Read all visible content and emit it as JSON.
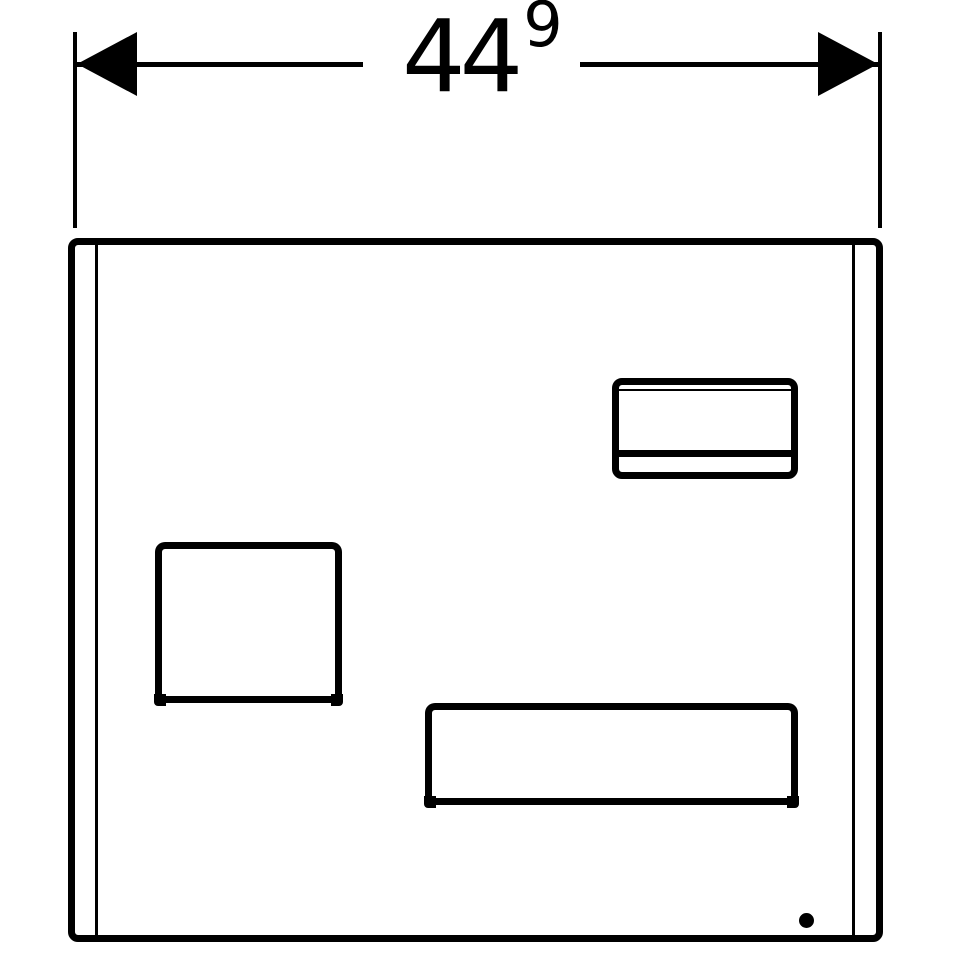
{
  "drawing": {
    "dimension": {
      "value": "44",
      "superscript": "9"
    },
    "colors": {
      "line": "#000000",
      "background": "#ffffff"
    }
  }
}
